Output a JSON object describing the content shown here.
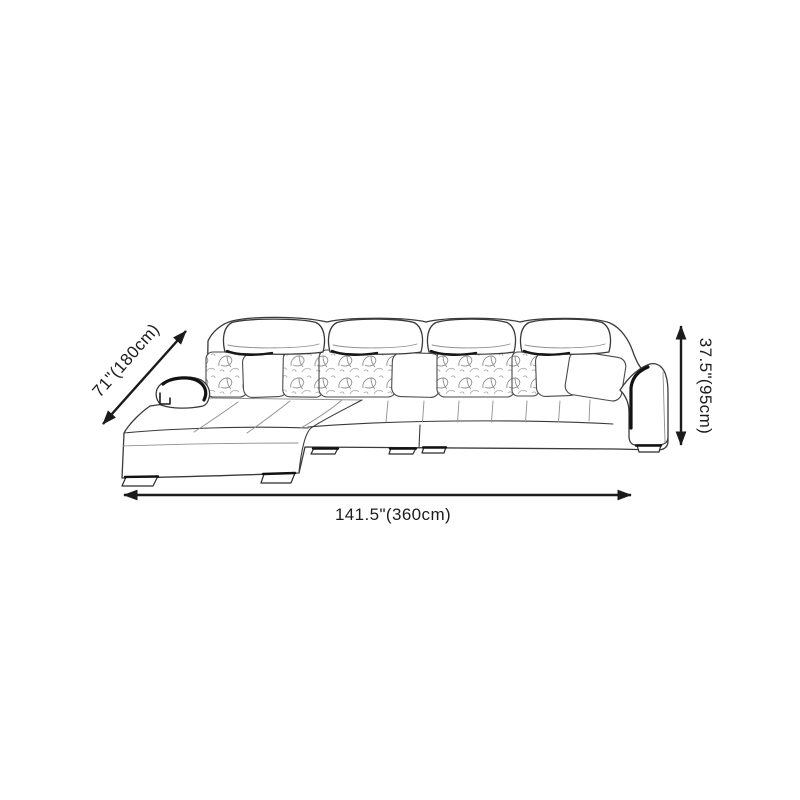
{
  "diagram": {
    "subject": "sectional-sofa-line-drawing",
    "background": "#ffffff"
  },
  "dimensions": {
    "depth": {
      "label": "71\"(180cm)"
    },
    "height": {
      "label": "37.5\"(95cm)"
    },
    "width": {
      "label": "141.5\"(360cm)"
    }
  },
  "colors": {
    "dimension_lines": "#1b1b1b",
    "sofa_outline": "#3a3a3a",
    "accent_trim": "#121212"
  }
}
